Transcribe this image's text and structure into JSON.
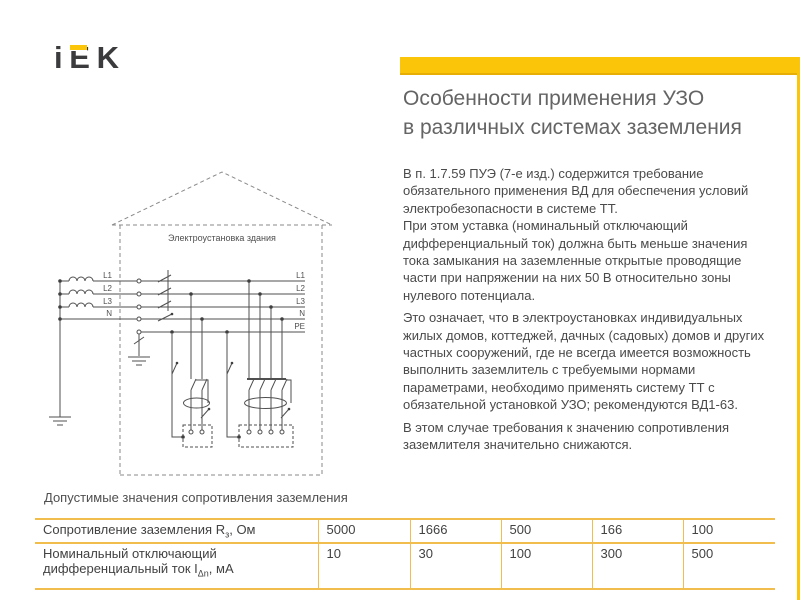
{
  "brand": {
    "i": "i",
    "e": "E",
    "k": "K"
  },
  "header": {
    "title_line1": "Особенности применения УЗО",
    "title_line2": "в различных системах заземления"
  },
  "body": {
    "paragraphs": [
      "В п. 1.7.59 ПУЭ (7-е изд.) содержится требование обязательного применения ВД для обеспечения условий электробезопасности в системе ТТ.",
      "При этом уставка (номинальный отключающий дифференциальный ток) должна быть меньше значения тока замыкания на заземленные открытые проводящие части при напряжении на них 50 В относительно зоны нулевого потенциала.",
      "Это означает, что в электроустановках индивидуальных жилых домов, коттеджей, дачных (садовых) домов и других частных сооружений, где не всегда имеется возможность выполнить заземлитель с требуемыми нормами параметрами, необходимо применять систему ТТ с обязательной установкой УЗО; рекомендуются ВД1-63.",
      "В этом случае требования к значению сопротивления заземлителя значительно снижаются."
    ]
  },
  "diagram": {
    "house_label": "Электроустановка здания",
    "left_labels": [
      "L1",
      "L2",
      "L3",
      "N"
    ],
    "right_labels": [
      "L1",
      "L2",
      "L3",
      "N",
      "PE"
    ]
  },
  "table_caption": "Допустимые значения сопротивления заземления",
  "table": {
    "rows": [
      {
        "label": "Сопротивление заземления R",
        "sub": "з",
        "tail": ", Ом",
        "values": [
          "5000",
          "1666",
          "500",
          "166",
          "100"
        ]
      },
      {
        "label": "Номинальный отключающий дифференциальный ток I",
        "sub": "Δn",
        "tail": ", мА",
        "values": [
          "10",
          "30",
          "100",
          "300",
          "500"
        ]
      }
    ]
  },
  "colors": {
    "accent": "#FBC60A",
    "table_border": "#F1BE4E",
    "logo_dark": "#3B3B3D",
    "title_text": "#646464",
    "body_text": "#4A4A4A"
  }
}
